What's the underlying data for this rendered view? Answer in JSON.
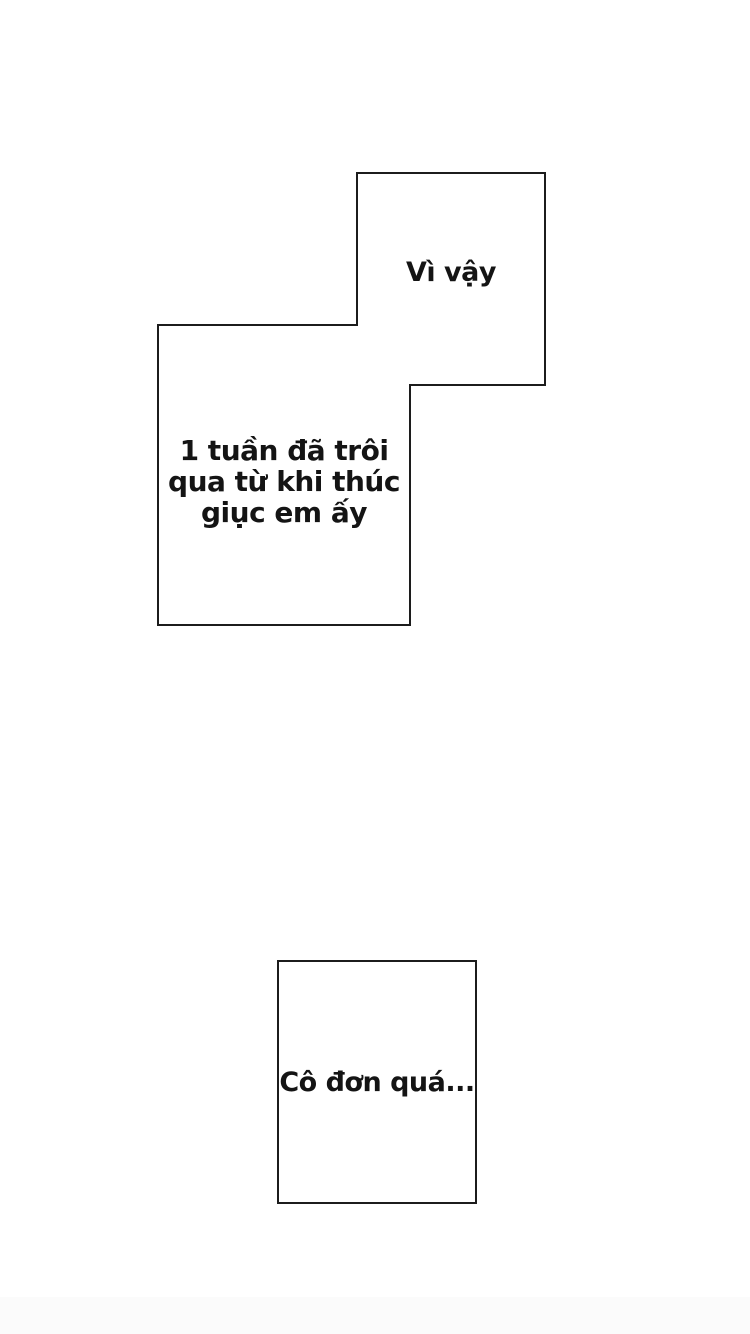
{
  "page": {
    "background": "#ffffff",
    "panel_fill": "#ffffff",
    "panel_line_color": "#1c1c1c",
    "text_color": "#141414",
    "bottom_edge_tint": "#fbfbfb"
  },
  "speech": {
    "top": {
      "text": "Vì vậy"
    },
    "middle": {
      "lines": [
        "1 tuần đã trôi",
        "qua từ khi thúc",
        "giục em ấy"
      ]
    },
    "bottom": {
      "text": "Cô đơn quá..."
    }
  }
}
